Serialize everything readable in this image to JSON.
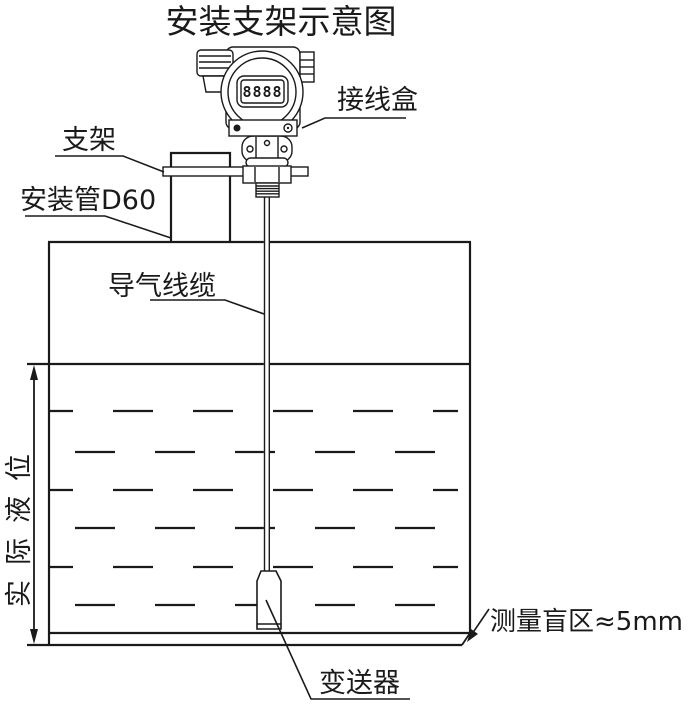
{
  "diagram": {
    "title": "安装支架示意图",
    "device": {
      "lcd_digits": "8888",
      "junction_box_label": "接线盒"
    },
    "mounting": {
      "bracket_label": "支架",
      "pipe_label": "安装管D60"
    },
    "tank": {
      "cable_label": "导气线缆",
      "level_label": "实际液位",
      "blind_zone_label": "测量盲区≈5mm",
      "probe_label": "变送器"
    },
    "colors": {
      "line": "#1a1a1a",
      "background": "#ffffff"
    }
  }
}
